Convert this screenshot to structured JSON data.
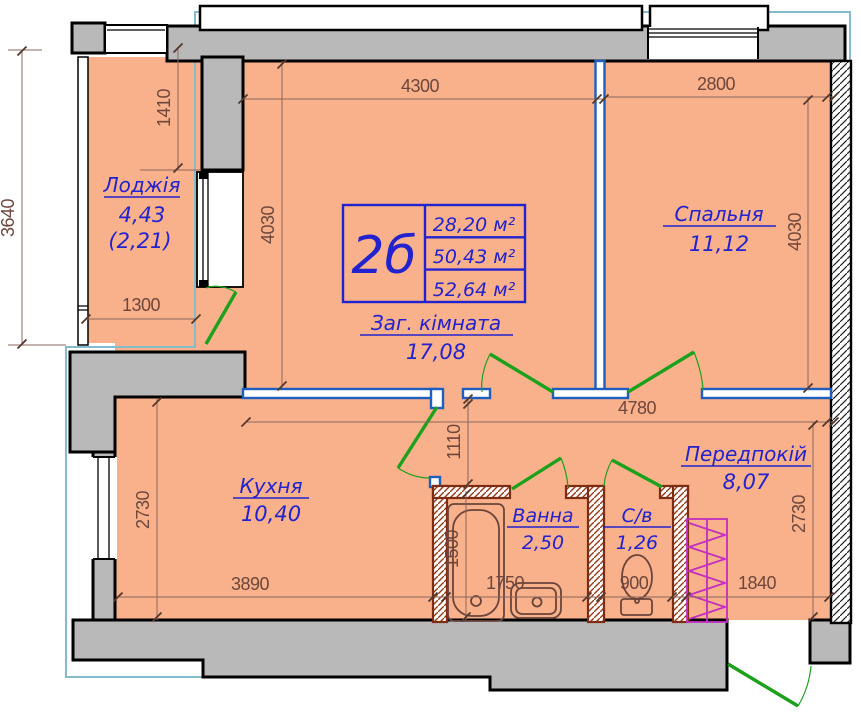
{
  "summary_table": {
    "unit_type": "2б",
    "rows": [
      "28,20 м²",
      "50,43 м²",
      "52,64 м²"
    ]
  },
  "rooms": {
    "loggia": {
      "name": "Лоджія",
      "area": "4,43",
      "area_reduced": "(2,21)"
    },
    "bedroom": {
      "name": "Спальня",
      "area": "11,12"
    },
    "living": {
      "name": "Заг. кімната",
      "area": "17,08"
    },
    "kitchen": {
      "name": "Кухня",
      "area": "10,40"
    },
    "hall": {
      "name": "Передпокій",
      "area": "8,07"
    },
    "bath": {
      "name": "Ванна",
      "area": "2,50"
    },
    "wc": {
      "name": "С/в",
      "area": "1,26"
    }
  },
  "dims": {
    "living_width": "4300",
    "bedroom_width": "2800",
    "living_depth": "4030",
    "bedroom_depth": "4030",
    "loggia_wall": "1410",
    "loggia_glazing": "3640",
    "loggia_door": "1300",
    "hall_width": "4780",
    "hall_passage": "1110",
    "kitchen_depth": "2730",
    "hall_depth": "2730",
    "kitchen_width": "3890",
    "bath_width": "1750",
    "bath_depth": "1500",
    "wc_width": "900",
    "entry_width": "1840"
  },
  "colors": {
    "floor": "#f8b18a",
    "wall": "#b9b9b9",
    "partition": "#1d5ebe",
    "label": "#2222cf",
    "door": "#1ca11c",
    "wardrobe": "#c22ec2",
    "wet_wall": "#7d2c12",
    "dim_text": "#6d463c",
    "envelope": "#85bccd"
  }
}
